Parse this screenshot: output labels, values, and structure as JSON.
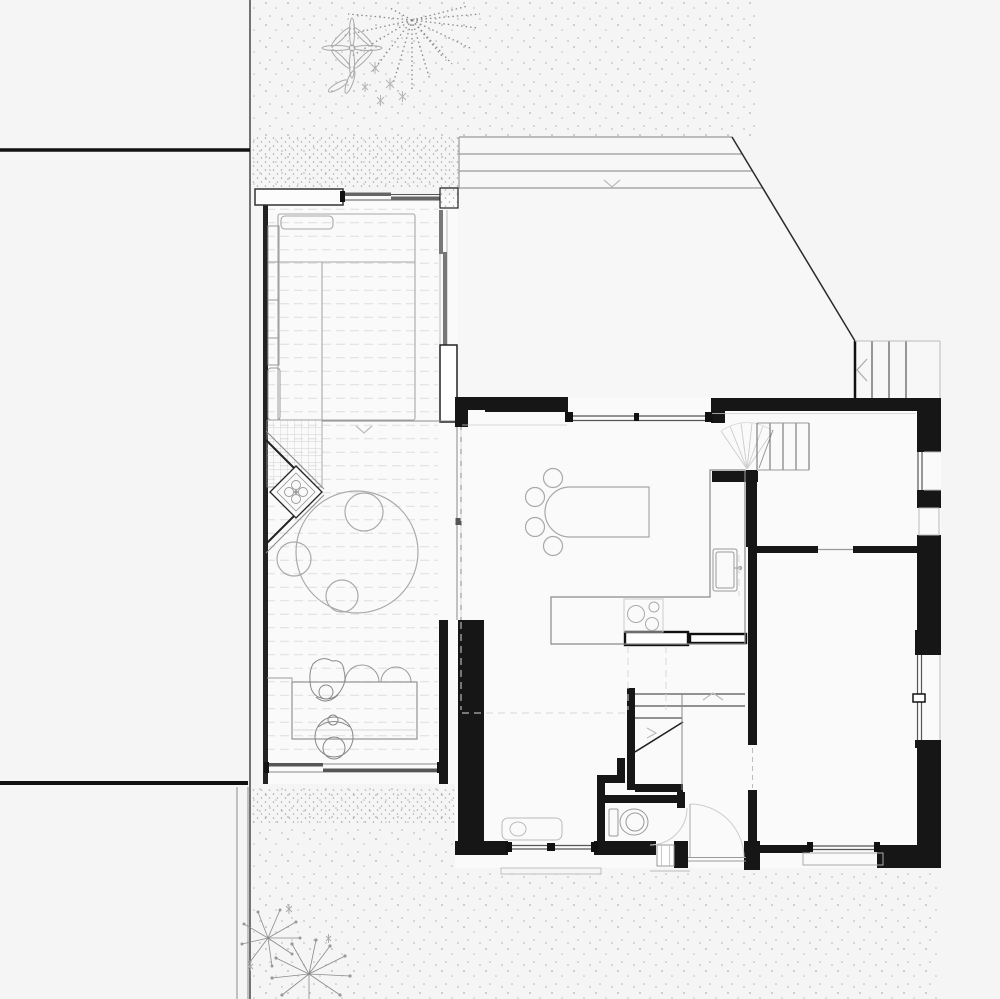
{
  "document": {
    "type": "architectural-floor-plan",
    "title": "Ground floor plan: house with veranda annex, timber deck, terrace and garden",
    "visible_text": []
  },
  "palette": {
    "background": "#f5f5f5",
    "interior_fill": "#fafafa",
    "terrace_fill": "#f7f7f7",
    "wall": "#161616",
    "line_dark": "#333333",
    "line_medium": "#888888",
    "line_light": "#bbbbbb",
    "dash_line": "#dedede",
    "glazing": "#666666",
    "stipple": "#b3b3b3"
  },
  "site": {
    "context": [
      "neighbor-building-north",
      "neighbor-building-south",
      "property-boundary-line",
      "gravel-ground-north",
      "gravel-ground-south"
    ],
    "vegetation": {
      "large-radial-tree": 1,
      "star-leaf-plant": 1,
      "umbel-plants": 2,
      "small-flower-clusters": 7
    }
  },
  "rooms": [
    {
      "id": "veranda-annex",
      "contents": [
        "futon-bed",
        "pillow",
        "side-bench",
        "grid-mat",
        "corner-bay-with-flower"
      ]
    },
    {
      "id": "timber-deck",
      "contents": [
        "round-rug",
        "floor-cushions-x3",
        "low-table",
        "seated-figures-x2",
        "dome-cushions-x2"
      ]
    },
    {
      "id": "living-dining",
      "contents": [
        "dining-table",
        "dining-chairs-x4"
      ]
    },
    {
      "id": "kitchen",
      "contents": [
        "l-shaped-counter",
        "sink",
        "cooktop-3-burners"
      ]
    },
    {
      "id": "stair-hall",
      "contents": [
        "interior-stair-upper-flight",
        "door-swing-fan"
      ]
    },
    {
      "id": "upper-right-room",
      "contents": []
    },
    {
      "id": "bottom-right-room",
      "contents": []
    },
    {
      "id": "wc",
      "contents": [
        "toilet",
        "door-arc"
      ]
    },
    {
      "id": "bathroom",
      "contents": [
        "washbasin"
      ]
    },
    {
      "id": "entry",
      "contents": [
        "front-door-arc",
        "porch-step"
      ]
    },
    {
      "id": "terrace-north",
      "contents": [
        "roof-edge-lines",
        "diagonal-boundary",
        "exterior-stairs-4-steps"
      ]
    }
  ],
  "stairs": {
    "exterior-steps": 4,
    "interior-upper-flight-treads": 5,
    "interior-lower-flight-treads": 3
  },
  "openings": {
    "sliding-windows": 5,
    "fixed-windows": 4,
    "hinged-door-arcs": 3,
    "door-swing-fan": 1
  },
  "markers": {
    "level-chevrons": 5
  }
}
